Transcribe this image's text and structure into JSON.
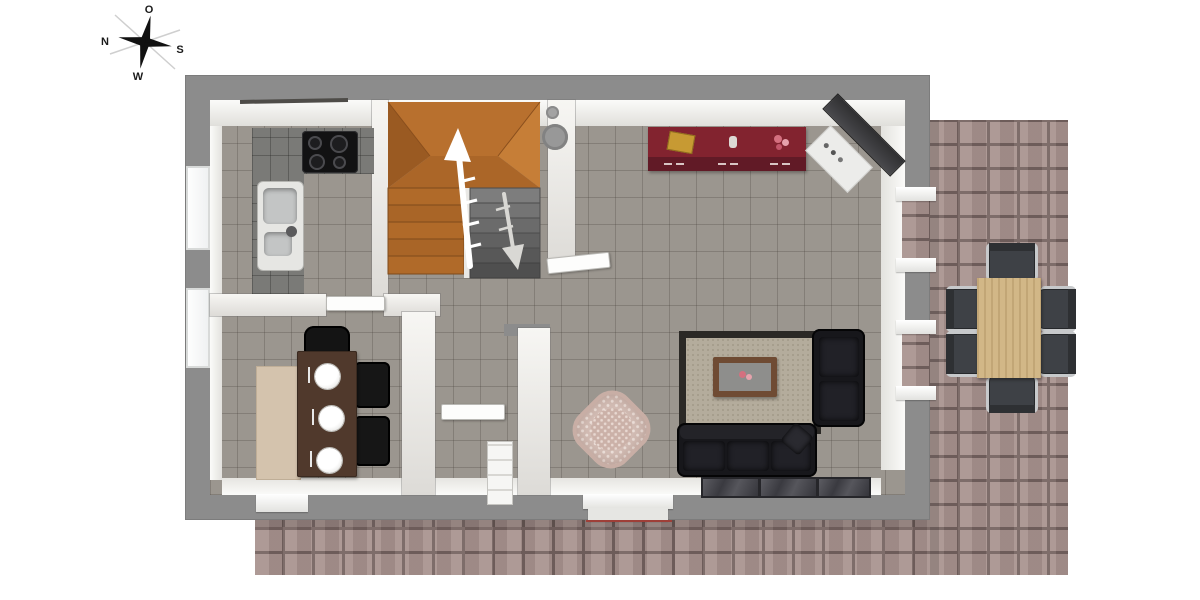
{
  "compass": {
    "north": "N",
    "east": "O",
    "south": "S",
    "west": "W"
  },
  "palette": {
    "background": "#ffffff",
    "exterior_wall_gray": "#8c8c8c",
    "interior_wall_face": "#f3f2ef",
    "floor_tile_gray": "#9b968f",
    "patio_brick": "#a8928e",
    "brick_joint": "#74625f",
    "stairs_wood": "#b26d2b",
    "basement_stairs_gray": "#6e6e6e",
    "sideboard_red": "#7b2130",
    "sofa_black": "#17171b",
    "rug_beige": "#b4ac9c",
    "rug_border": "#2b2926",
    "coffee_table_brown": "#6f4b33",
    "wicker_chair": "#d5bfb7",
    "dining_table_brown": "#50392c",
    "dining_sideboard_tan": "#d4c3ad",
    "outdoor_table_wood": "#d2b787",
    "outdoor_chair_gray": "#3e4146",
    "threshold_red": "#9e3f38"
  },
  "furniture": [
    "compass-rose",
    "kitchen-counter",
    "cooktop",
    "kitchen-sink",
    "staircase",
    "up-arrow",
    "down-arrow",
    "chimney",
    "red-sideboard",
    "corner-shelf",
    "corner-cabinet",
    "area-rug",
    "coffee-table",
    "sofa",
    "armchair",
    "floor-mats",
    "wicker-chair",
    "dining-table",
    "dining-chairs",
    "tan-sideboard",
    "radiator",
    "interior-doors",
    "windows",
    "patio-steps",
    "outdoor-dining-table",
    "outdoor-chairs",
    "brick-patio"
  ]
}
